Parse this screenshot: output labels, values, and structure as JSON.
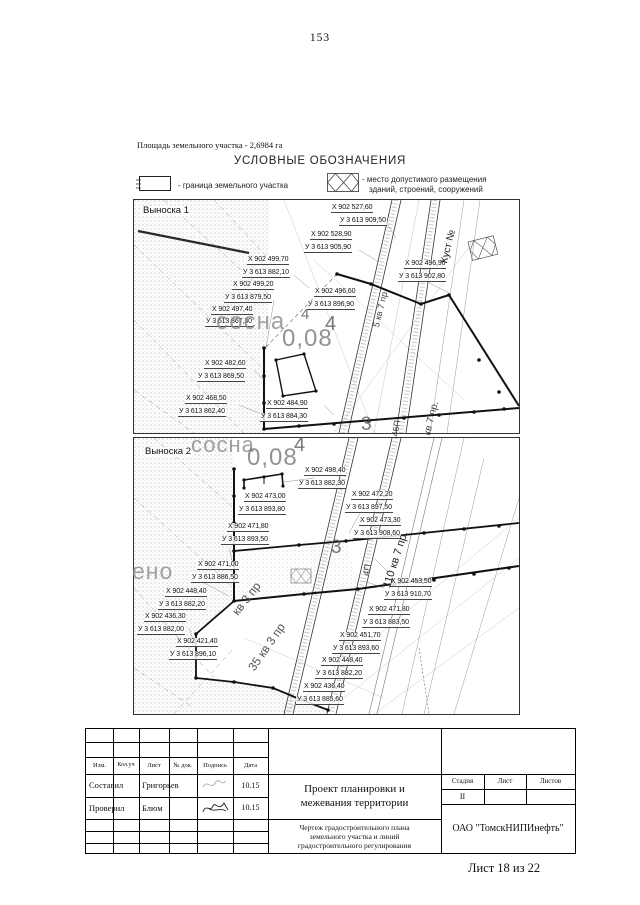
{
  "page": {
    "number": "153",
    "area_note": "Площадь земельного участка - 2,6984 га",
    "footer": "Лист 18 из 22"
  },
  "legend": {
    "title": "УСЛОВНЫЕ ОБОЗНАЧЕНИЯ",
    "item1_label": "- граница земельного участка",
    "item2_label_line1": "- место допустимого размещения",
    "item2_label_line2": "зданий, строений, сооружений"
  },
  "panels": {
    "v1": {
      "name": "Выноска 1",
      "labels": [
        {
          "t": "Выноска 1",
          "x": 7,
          "y": 6,
          "cls": "ptitle"
        },
        {
          "t": "Х 902 527,60",
          "x": 197,
          "y": 4
        },
        {
          "t": "У 3 613 909,50",
          "x": 205,
          "y": 17
        },
        {
          "t": "Х 902 528,90",
          "x": 176,
          "y": 31
        },
        {
          "t": "У 3 613 905,90",
          "x": 170,
          "y": 44
        },
        {
          "t": "Х 902 499,70",
          "x": 113,
          "y": 56
        },
        {
          "t": "У 3 613 882,10",
          "x": 108,
          "y": 69
        },
        {
          "t": "Х 902 499,20",
          "x": 98,
          "y": 81
        },
        {
          "t": "У 3 613 879,50",
          "x": 90,
          "y": 94
        },
        {
          "t": "Х 902 497,40",
          "x": 77,
          "y": 106
        },
        {
          "t": "У 3 613 867,30",
          "x": 71,
          "y": 118
        },
        {
          "t": "Х 902 496,60",
          "x": 180,
          "y": 88
        },
        {
          "t": "У 3 613 896,90",
          "x": 173,
          "y": 101
        },
        {
          "t": "Х 902 496,90",
          "x": 270,
          "y": 60
        },
        {
          "t": "У 3 613 902,80",
          "x": 264,
          "y": 73
        },
        {
          "t": "Х 902 482,60",
          "x": 70,
          "y": 160
        },
        {
          "t": "У 3 613 869,50",
          "x": 63,
          "y": 173
        },
        {
          "t": "Х 902 468,50",
          "x": 51,
          "y": 195
        },
        {
          "t": "У 3 613 862,40",
          "x": 44,
          "y": 208
        },
        {
          "t": "Х 902 484,90",
          "x": 132,
          "y": 200
        },
        {
          "t": "У 3 613 884,30",
          "x": 126,
          "y": 213
        },
        {
          "t": "сосна",
          "x": 82,
          "y": 110,
          "s": 24,
          "c": "#8a8a8a",
          "cls": "big"
        },
        {
          "t": "4",
          "x": 167,
          "y": 107,
          "s": 15,
          "c": "#555",
          "cls": "big"
        },
        {
          "t": "4",
          "x": 191,
          "y": 114,
          "s": 20,
          "c": "#555",
          "cls": "big"
        },
        {
          "t": "0,08",
          "x": 148,
          "y": 127,
          "s": 24,
          "c": "#777",
          "cls": "big"
        },
        {
          "t": "3",
          "x": 227,
          "y": 215,
          "s": 19,
          "c": "#555",
          "cls": "big"
        },
        {
          "t": "5 кв 7 пр.",
          "x": 238,
          "y": 126,
          "r": -76,
          "s": 9,
          "c": "#444",
          "cls": "rot"
        },
        {
          "t": "Куст №",
          "x": 306,
          "y": 62,
          "r": -76,
          "s": 10,
          "c": "#222",
          "cls": "rot"
        },
        {
          "t": "46П",
          "x": 257,
          "y": 236,
          "r": -82,
          "s": 9,
          "c": "#444",
          "cls": "rot"
        },
        {
          "t": "кв 7 пр.",
          "x": 289,
          "y": 234,
          "r": -76,
          "s": 10,
          "c": "#444",
          "cls": "rot"
        }
      ]
    },
    "v2": {
      "name": "Выноска 2",
      "labels": [
        {
          "t": "Выноска 2",
          "x": 9,
          "y": 9,
          "cls": "ptitle"
        },
        {
          "t": "Х 902 498,40",
          "x": 170,
          "y": 29
        },
        {
          "t": "У 3 613 882,30",
          "x": 164,
          "y": 42
        },
        {
          "t": "Х 902 473,00",
          "x": 110,
          "y": 55
        },
        {
          "t": "У 3 613 893,80",
          "x": 104,
          "y": 68
        },
        {
          "t": "Х 902 472,20",
          "x": 217,
          "y": 53
        },
        {
          "t": "У 3 613 897,50",
          "x": 211,
          "y": 66
        },
        {
          "t": "Х 902 473,30",
          "x": 225,
          "y": 79
        },
        {
          "t": "У 3 613 908,60",
          "x": 219,
          "y": 92
        },
        {
          "t": "Х 902 471,80",
          "x": 93,
          "y": 85
        },
        {
          "t": "У 3 613 893,50",
          "x": 87,
          "y": 98
        },
        {
          "t": "Х 902 471,00",
          "x": 63,
          "y": 123
        },
        {
          "t": "У 3 613 886,50",
          "x": 57,
          "y": 136
        },
        {
          "t": "Х 902 448,40",
          "x": 31,
          "y": 150
        },
        {
          "t": "У 3 613 882,20",
          "x": 24,
          "y": 163
        },
        {
          "t": "Х 902 436,30",
          "x": 10,
          "y": 175
        },
        {
          "t": "У 3 613 882,00",
          "x": 3,
          "y": 188
        },
        {
          "t": "Х 902 421,40",
          "x": 42,
          "y": 200
        },
        {
          "t": "У 3 613 896,10",
          "x": 35,
          "y": 213
        },
        {
          "t": "Х 902 453,50",
          "x": 256,
          "y": 140
        },
        {
          "t": "У 3 613 910,70",
          "x": 250,
          "y": 153
        },
        {
          "t": "Х 902 471,80",
          "x": 234,
          "y": 168
        },
        {
          "t": "У 3 613 883,50",
          "x": 228,
          "y": 181
        },
        {
          "t": "Х 902 451,70",
          "x": 205,
          "y": 194
        },
        {
          "t": "У 3 613 893,60",
          "x": 198,
          "y": 207
        },
        {
          "t": "Х 902 448,40",
          "x": 187,
          "y": 219
        },
        {
          "t": "У 3 613 882,20",
          "x": 181,
          "y": 232
        },
        {
          "t": "Х 902 436,40",
          "x": 169,
          "y": 245
        },
        {
          "t": "У 3 613 885,60",
          "x": 162,
          "y": 258
        },
        {
          "t": "сосна",
          "x": 57,
          "y": -4,
          "s": 22,
          "c": "#8a8a8a",
          "cls": "big"
        },
        {
          "t": "0,08",
          "x": 113,
          "y": 8,
          "s": 24,
          "c": "#777",
          "cls": "big"
        },
        {
          "t": "4",
          "x": 160,
          "y": -3,
          "s": 20,
          "c": "#555",
          "cls": "big"
        },
        {
          "t": "3",
          "x": 197,
          "y": 100,
          "s": 19,
          "c": "#555",
          "cls": "big"
        },
        {
          "t": "ено",
          "x": -2,
          "y": 122,
          "s": 23,
          "c": "#8a8a8a",
          "cls": "big"
        },
        {
          "t": "110 кв 7 пр.",
          "x": 248,
          "y": 148,
          "r": -72,
          "s": 11,
          "c": "#222",
          "cls": "rot"
        },
        {
          "t": "4П",
          "x": 228,
          "y": 137,
          "r": -80,
          "s": 9,
          "c": "#444",
          "cls": "rot"
        },
        {
          "t": "кв 3 пр",
          "x": 96,
          "y": 172,
          "r": -52,
          "s": 12,
          "c": "#555",
          "cls": "rot"
        },
        {
          "t": "35 кв 3 пр",
          "x": 112,
          "y": 228,
          "r": -55,
          "s": 12,
          "c": "#555",
          "cls": "rot"
        }
      ]
    }
  },
  "title_block": {
    "columns": [
      "Изм.",
      "Кол.уч",
      "Лист",
      "№ док.",
      "Подпись",
      "Дата"
    ],
    "row1": {
      "role": "Составил",
      "name": "Григорьев",
      "date": "10.15"
    },
    "row2": {
      "role": "Проверил",
      "name": "Блюм",
      "date": "10.15"
    },
    "project_line1": "Проект планировки и",
    "project_line2": "межевания территории",
    "drawing_line1": "Чертеж градостроительного плана",
    "drawing_line2": "земельного участка и линий",
    "drawing_line3": "градостроительного регулирования",
    "stage_label": "Стадия",
    "sheet_label": "Лист",
    "sheets_label": "Листов",
    "stage_value": "II",
    "company": "ОАО \"ТомскНИПИнефть\""
  }
}
